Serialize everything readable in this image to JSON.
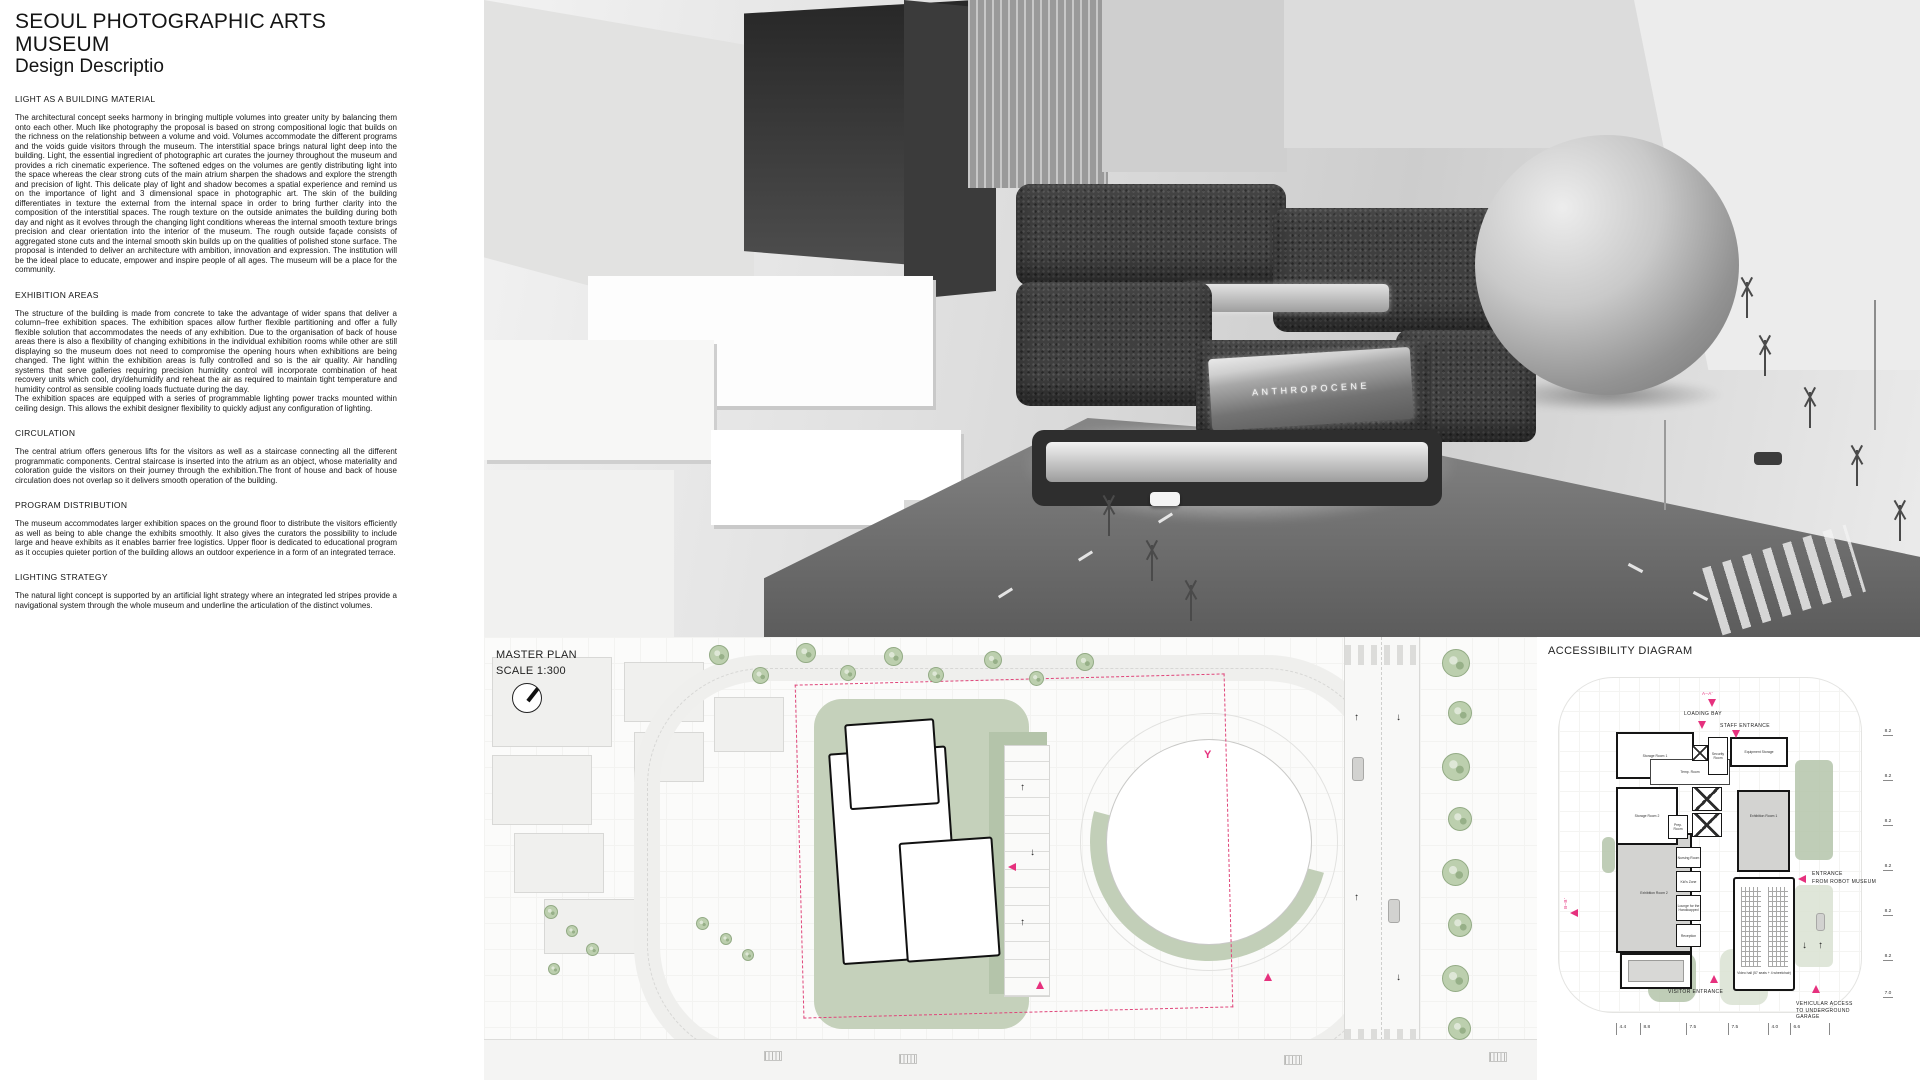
{
  "description_panel": {
    "title": "SEOUL PHOTOGRAPHIC ARTS MUSEUM",
    "subtitle": "Design Descriptio",
    "sections": [
      {
        "heading": "LIGHT AS A BUILDING MATERIAL",
        "body": "The architectural concept seeks harmony in bringing multiple volumes into greater unity by balancing them onto each other. Much like photography the proposal is based on strong compositional logic that builds on the richness on the relationship between a volume and void. Volumes accommodate the different programs and the voids guide visitors through the museum. The interstitial space brings natural light deep into the building. Light, the essential ingredient of photographic art curates the journey throughout the museum and provides a rich cinematic experience. The softened edges on the volumes are gently distributing light into the space whereas the clear strong cuts of the main atrium sharpen the shadows and explore the strength and precision of light. This delicate play of light and shadow becomes a spatial experience and remind us on the importance of light and 3 dimensional space in photographic art. The skin of the building differentiates in texture the external from the internal space in order to bring further clarity into the composition of the interstitial spaces. The rough texture on the outside animates the building during both day and night as it evolves through the changing light conditions whereas the internal smooth texture brings precision and clear orientation into the interior of the museum. The rough outside façade consists of aggregated stone cuts and the internal smooth skin builds up on the qualities of polished stone surface. The proposal is intended to deliver an architecture with ambition, innovation and expression. The institution will be the ideal place to educate, empower and inspire people of all ages. The museum will be a place for the community."
      },
      {
        "heading": "EXHIBITION AREAS",
        "body": "The structure of the building is made from concrete to take the advantage of wider spans that deliver a column–free exhibition spaces. The exhibition spaces allow further flexible partitioning and offer a fully flexible solution that accommodates the needs of any exhibition. Due to the organisation of back of house areas there is also a flexibility of changing exhibitions in the individual exhibition rooms while other are still displaying so the museum does not need to compromise the opening hours when exhibitions are being changed. The light within the exhibition areas is fully controlled and so is the air quality. Air handling systems that serve galleries requiring precision humidity control will incorporate combination of heat recovery units which cool, dry/dehumidify and reheat the air as required to maintain tight temperature and humidity control as sensible cooling loads fluctuate during the day.\nThe exhibition spaces are equipped with a series of programmable lighting power tracks mounted within ceiling design. This allows the exhibit designer flexibility to quickly adjust any configuration of lighting."
      },
      {
        "heading": "CIRCULATION",
        "body": "The central atrium offers generous lifts for the visitors as well as a staircase connecting all the different programmatic components. Central staircase is inserted into the atrium as an object, whose materiality and coloration guide the visitors on their journey through the exhibition.The front of house and back of house circulation does not overlap so it delivers smooth operation of the building."
      },
      {
        "heading": "PROGRAM DISTRIBUTION",
        "body": "The museum accommodates larger exhibition spaces on the ground floor to distribute the visitors efficiently as well as being to able change the exhibits smoothly. It also gives the curators the possibility to include large and heave exhibits as it enables barrier free logistics. Upper floor is dedicated to educational program as it occupies quieter portion of the building allows an outdoor experience in a form of an integrated terrace."
      },
      {
        "heading": "LIGHTING STRATEGY",
        "body": "The natural light concept is supported  by an artificial light strategy where an integrated led stripes provide a navigational system through the whole museum and underline the articulation of the distinct volumes."
      }
    ]
  },
  "render": {
    "billboard_text": "ANTHROPOCENE"
  },
  "master_plan": {
    "title": "MASTER PLAN",
    "scale": "SCALE 1:300"
  },
  "accessibility_diagram": {
    "title": "ACCESSIBILITY DIAGRAM",
    "accent_color": "#e6317e",
    "annotations": {
      "loading_bay": "LOADING BAY",
      "staff_entrance": "STAFF ENTRANCE",
      "robot_entrance_line1": "ENTRANCE",
      "robot_entrance_line2": "FROM ROBOT MUSEUM",
      "visitor_entrance": "VISITOR ENTRANCE",
      "vehicular_line1": "VEHICULAR ACCESS",
      "vehicular_line2": "TO UNDERGROUND",
      "vehicular_line3": "GARAGE",
      "section_a": "A–A'",
      "section_b": "B–B'"
    },
    "rooms": {
      "storage1": "Storage Room 1",
      "storage2": "Storage Room 2",
      "security": "Security Room",
      "equipment": "Equipment Storage",
      "temp": "Temp. Room",
      "prep": "Prep. Room",
      "exhibition1": "Exhibition Room 1",
      "exhibition2": "Exhibition Room 2",
      "nursing": "Nursing Room",
      "kids": "Kid's Zone",
      "lounge": "Lounge for the Handicapped",
      "reception": "Reception",
      "video_hall": "Video hall (57 seats + 4 wheelchair)"
    },
    "dims_right": [
      "8.2",
      "8.2",
      "8.2",
      "8.2",
      "8.2",
      "8.2",
      "7.0"
    ],
    "dims_bottom": [
      "4.4",
      "8.8",
      "7.5",
      "7.5",
      "4.0",
      "6.6"
    ]
  }
}
